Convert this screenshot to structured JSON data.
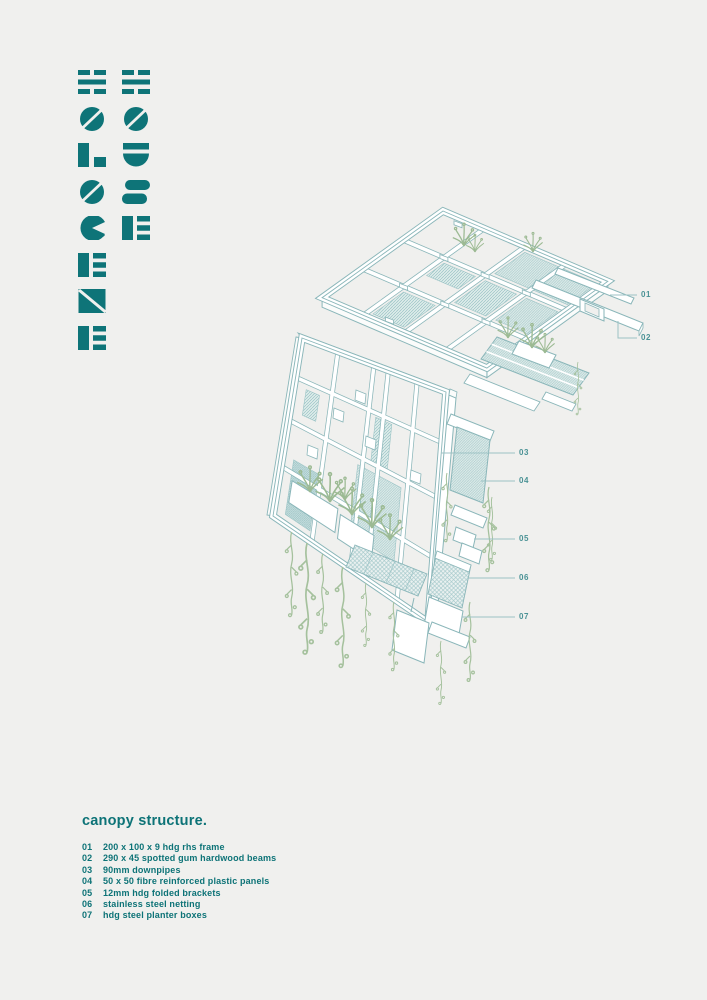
{
  "poster": {
    "background": "#f0f0ee",
    "accent_teal": "#0e7478",
    "line_teal": "#8ab6b9",
    "callout_teal": "#4a9295",
    "plant_green": "#9cba93"
  },
  "logo": {
    "word_left": "HOLOCENE",
    "word_right": "HOUSE",
    "letters_left": [
      "H",
      "O",
      "L",
      "O",
      "C",
      "E",
      "N",
      "E"
    ],
    "letters_right": [
      "H",
      "O",
      "U",
      "S",
      "E"
    ],
    "color": "#0e7478"
  },
  "drawing": {
    "callouts": [
      {
        "id": "01"
      },
      {
        "id": "02"
      },
      {
        "id": "03"
      },
      {
        "id": "04"
      },
      {
        "id": "05"
      },
      {
        "id": "06"
      },
      {
        "id": "07"
      }
    ]
  },
  "legend": {
    "title": "canopy structure.",
    "items": [
      {
        "num": "01",
        "label": "200 x 100 x 9 hdg rhs frame"
      },
      {
        "num": "02",
        "label": "290 x 45 spotted gum hardwood beams"
      },
      {
        "num": "03",
        "label": "90mm downpipes"
      },
      {
        "num": "04",
        "label": "50 x 50 fibre reinforced plastic panels"
      },
      {
        "num": "05",
        "label": "12mm hdg folded brackets"
      },
      {
        "num": "06",
        "label": "stainless steel netting"
      },
      {
        "num": "07",
        "label": "hdg steel planter boxes"
      }
    ]
  }
}
